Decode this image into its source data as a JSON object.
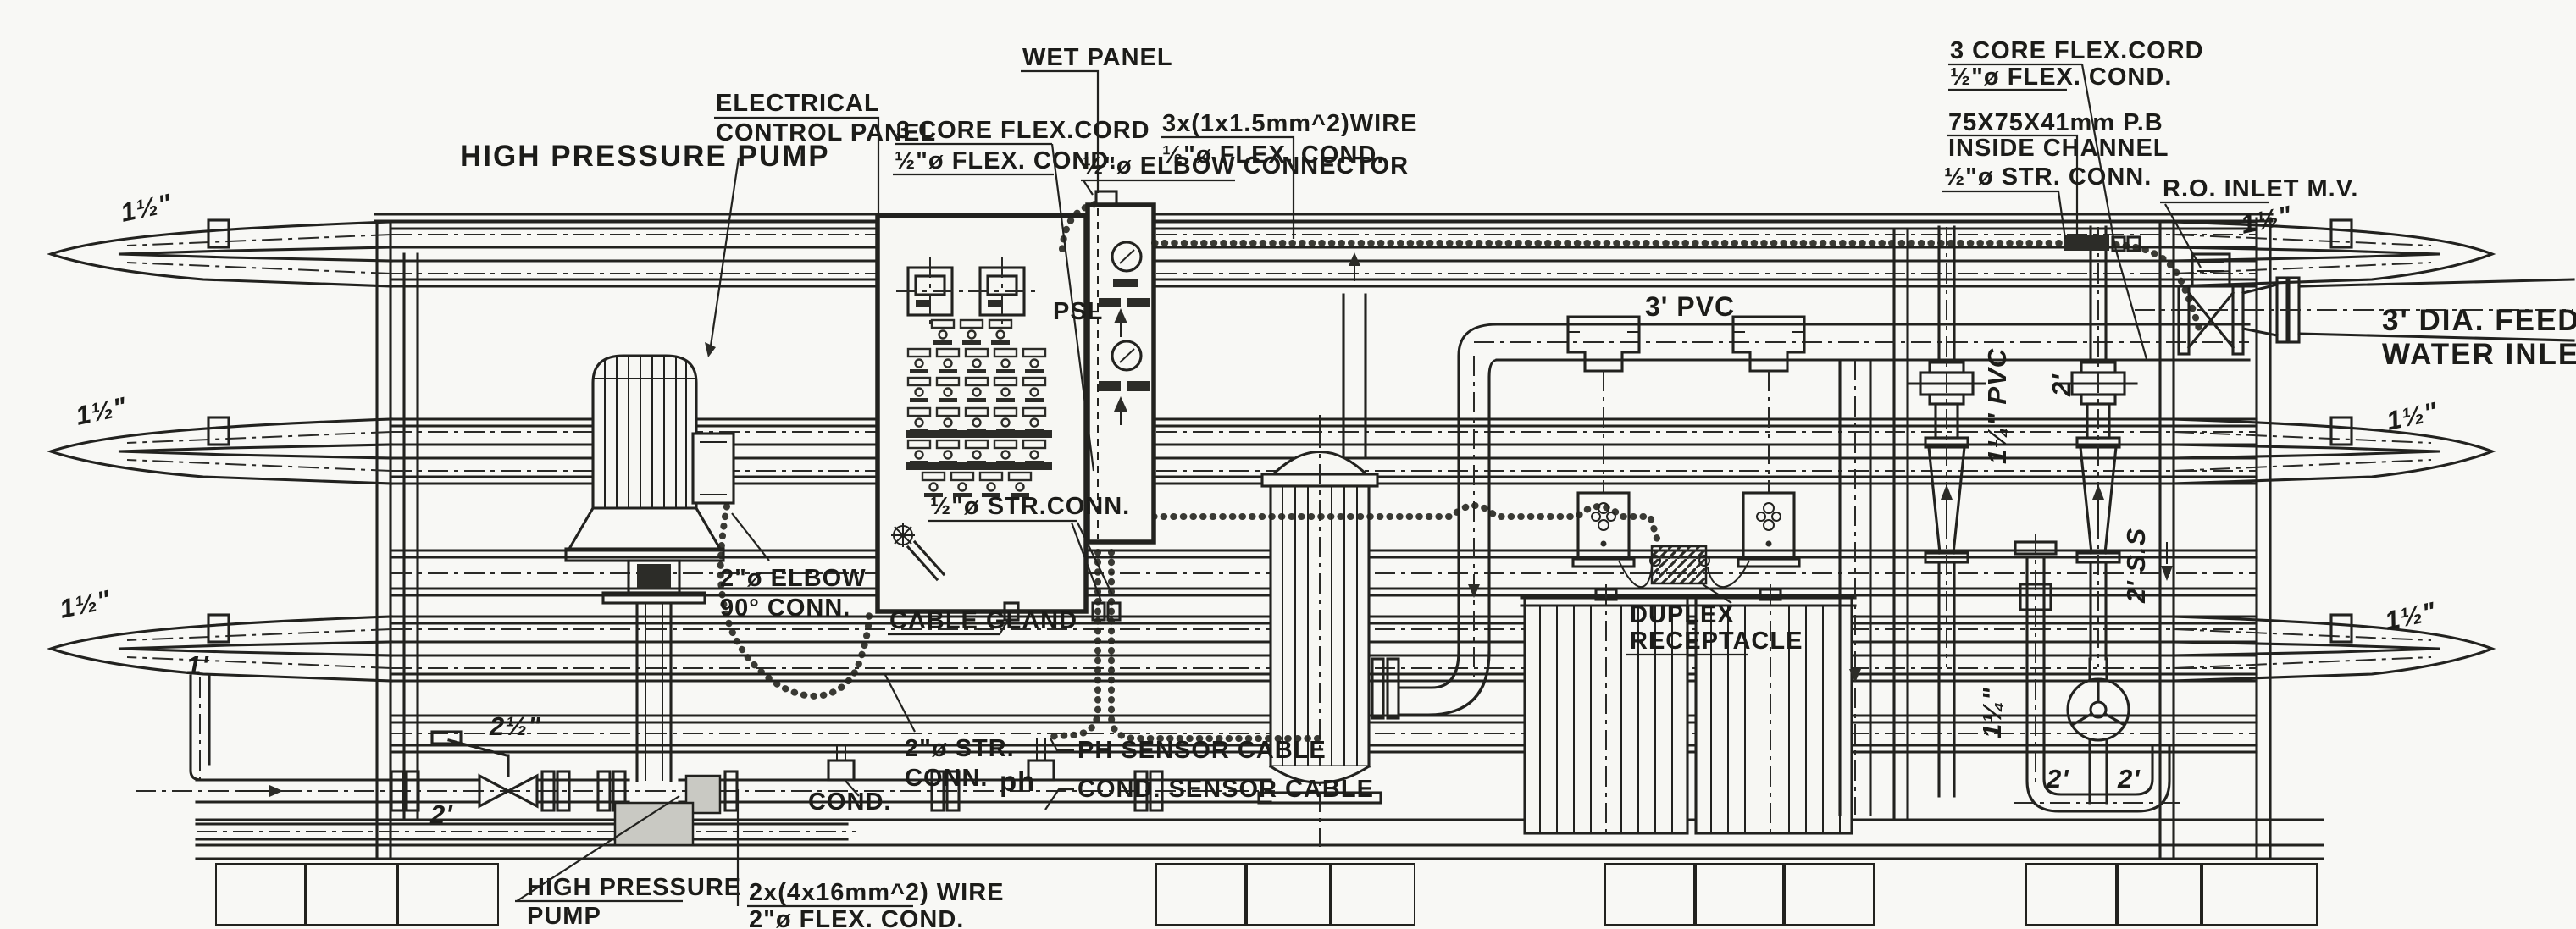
{
  "palette": {
    "ink": "#22221f",
    "paper": "#f8f8f5"
  },
  "labels": {
    "high_pressure_pump_top": "HIGH PRESSURE PUMP",
    "electrical_line1": "ELECTRICAL",
    "electrical_line2": "CONTROL PANEL",
    "core3_top_line1": "3 CORE FLEX.CORD",
    "core3_top_line2": "½\"ø FLEX. COND.",
    "wet_panel": "WET PANEL",
    "wire3x_line1": "3x(1x1.5mm^2)WIRE",
    "wire3x_line2": "½\"ø FLEX. COND.",
    "elbow_connector": "½\"ø ELBOW CONNECTOR",
    "psl": "PSL",
    "str_conn_half_mid": "½\"ø STR.CONN.",
    "elbow90_line1": "2\"ø ELBOW",
    "elbow90_line2": "90° CONN.",
    "cable_gland": "CABLE GLAND",
    "str_conn2_line1": "2\"ø STR.",
    "str_conn2_line2": "CONN.",
    "ph": "ph",
    "ph_sensor_cable": "PH SENSOR CABLE",
    "cond_sensor_cable": "COND. SENSOR CABLE",
    "cond": "COND.",
    "hpp_bottom_line1": "HIGH PRESSURE",
    "hpp_bottom_line2": "PUMP",
    "wire2x_line1": "2x(4x16mm^2) WIRE",
    "wire2x_line2": "2\"ø FLEX. COND.",
    "pvc3": "3' PVC",
    "duplex_line1": "DUPLEX",
    "duplex_line2": "RECEPTACLE",
    "core3_right_line1": "3 CORE FLEX.CORD",
    "core3_right_line2": "½\"ø FLEX. COND.",
    "pb_line1": "75X75X41mm P.B",
    "pb_line2": "INSIDE CHANNEL",
    "str_conn_half_right": "½\"ø STR. CONN.",
    "ro_inlet_mv": "R.O. INLET M.V.",
    "feed_line1": "3' DIA. FEED",
    "feed_line2": "WATER INLET",
    "size_15_left1": "1½\"",
    "size_15_left2": "1½\"",
    "size_15_left3": "1½\"",
    "size_1": "1'",
    "size_25": "2½\"",
    "size_2_bottomleft": "2'",
    "size_15_right1": "1½\"",
    "size_15_right2": "1½\"",
    "size_15_right3": "1½\"",
    "pvc_125_vertical": "1¼\" PVC",
    "size_2_vertical": "2'",
    "ss2_vertical": "2' S.S",
    "size_125_vertical": "1¼\"",
    "size_2_u_left": "2'",
    "size_2_u_right": "2'"
  }
}
